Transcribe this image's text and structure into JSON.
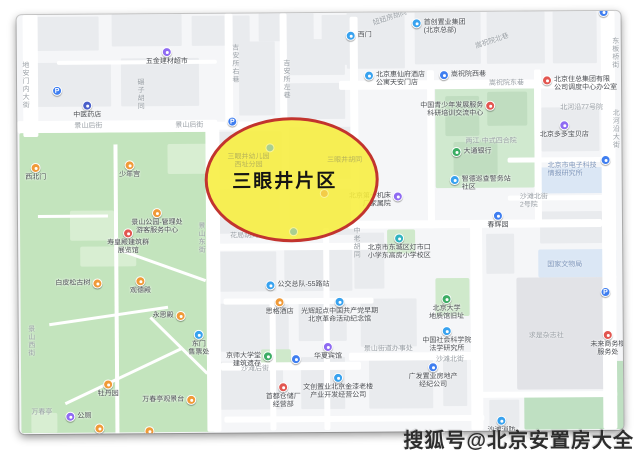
{
  "watermark": {
    "text": "搜狐号@北京安置房大全"
  },
  "highlight": {
    "label": "三眼井片区",
    "x": 187,
    "y": 104,
    "w": 174,
    "h": 125,
    "fill": "rgba(247,238,62,0.88)",
    "border": "#c2342e"
  },
  "icon_colors": {
    "blue": "#3f7ef0",
    "lightblue": "#38a2ef",
    "teal": "#2fb3c0",
    "purple": "#8f6bf2",
    "orange": "#f09a38",
    "red": "#e25650",
    "green": "#3cad64",
    "darkblue": "#4a5fc9"
  },
  "blocks": [
    {
      "x": 20,
      "y": 2,
      "w": 62,
      "h": 34
    },
    {
      "x": 95,
      "y": 0,
      "w": 70,
      "h": 32
    },
    {
      "x": 175,
      "y": 2,
      "w": 58,
      "h": 30
    },
    {
      "x": 242,
      "y": 0,
      "w": 55,
      "h": 28
    },
    {
      "x": 305,
      "y": 2,
      "w": 40,
      "h": 50
    },
    {
      "x": 16,
      "y": 48,
      "w": 78,
      "h": 44
    },
    {
      "x": 104,
      "y": 44,
      "w": 78,
      "h": 48
    },
    {
      "x": 222,
      "y": 28,
      "w": 36,
      "h": 74
    },
    {
      "x": 270,
      "y": 26,
      "w": 58,
      "h": 36
    },
    {
      "x": 270,
      "y": 70,
      "w": 58,
      "h": 36
    },
    {
      "x": 198,
      "y": 118,
      "w": 66,
      "h": 48
    },
    {
      "x": 272,
      "y": 114,
      "w": 66,
      "h": 52
    },
    {
      "x": 200,
      "y": 176,
      "w": 62,
      "h": 44
    },
    {
      "x": 272,
      "y": 176,
      "w": 66,
      "h": 46
    },
    {
      "x": 196,
      "y": 238,
      "w": 62,
      "h": 40
    },
    {
      "x": 266,
      "y": 234,
      "w": 68,
      "h": 44
    },
    {
      "x": 200,
      "y": 290,
      "w": 70,
      "h": 48
    },
    {
      "x": 280,
      "y": 288,
      "w": 48,
      "h": 40
    },
    {
      "x": 198,
      "y": 348,
      "w": 66,
      "h": 48
    },
    {
      "x": 282,
      "y": 344,
      "w": 44,
      "h": 52
    },
    {
      "x": 336,
      "y": 220,
      "w": 30,
      "h": 56
    },
    {
      "x": 342,
      "y": 286,
      "w": 56,
      "h": 48
    },
    {
      "x": 350,
      "y": 342,
      "w": 64,
      "h": 54
    },
    {
      "x": 424,
      "y": 344,
      "w": 24,
      "h": 50
    },
    {
      "x": 468,
      "y": 222,
      "w": 28,
      "h": 40
    },
    {
      "x": 330,
      "y": 0,
      "w": 58,
      "h": 56
    },
    {
      "x": 398,
      "y": 0,
      "w": 66,
      "h": 52
    },
    {
      "x": 470,
      "y": 0,
      "w": 58,
      "h": 52
    },
    {
      "x": 536,
      "y": 0,
      "w": 44,
      "h": 52
    },
    {
      "x": 524,
      "y": 96,
      "w": 58,
      "h": 44
    },
    {
      "x": 522,
      "y": 200,
      "w": 62,
      "h": 32
    },
    {
      "x": 470,
      "y": 388,
      "w": 30,
      "h": 28
    }
  ],
  "areas": [
    {
      "x": 2,
      "y": 118,
      "w": 194,
      "h": 300,
      "c": "#c3e4bd",
      "name": "jingshan-park"
    },
    {
      "x": 52,
      "y": 196,
      "w": 44,
      "h": 30,
      "c": "#d8eed2",
      "name": "park-structure"
    },
    {
      "x": 62,
      "y": 232,
      "w": 56,
      "h": 20,
      "c": "#d8eed2",
      "name": "park-structure"
    },
    {
      "x": 12,
      "y": 398,
      "w": 26,
      "h": 20,
      "c": "#d8eed2",
      "name": "park-structure"
    },
    {
      "x": 150,
      "y": 130,
      "w": 40,
      "h": 30,
      "c": "#d8eed2",
      "name": "park-structure"
    },
    {
      "x": 418,
      "y": 74,
      "w": 99,
      "h": 102,
      "c": "#d0e9cf",
      "name": "temple-compound"
    },
    {
      "x": 428,
      "y": 84,
      "w": 34,
      "h": 40,
      "c": "#c0ddc0",
      "name": "compound-building"
    },
    {
      "x": 470,
      "y": 80,
      "w": 40,
      "h": 34,
      "c": "#c0ddc0",
      "name": "compound-building"
    },
    {
      "x": 436,
      "y": 130,
      "w": 44,
      "h": 34,
      "c": "#c0ddc0",
      "name": "compound-building"
    },
    {
      "x": 369,
      "y": 217,
      "w": 28,
      "h": 24,
      "c": "#cfe9cb",
      "name": "school-green"
    },
    {
      "x": 417,
      "y": 266,
      "w": 34,
      "h": 38,
      "c": "#cfe9cb",
      "name": "geology-hall-green"
    },
    {
      "x": 242,
      "y": 336,
      "w": 30,
      "h": 16,
      "c": "#cfe9cb",
      "name": "daxuetang-green"
    },
    {
      "x": 505,
      "y": 384,
      "w": 117,
      "h": 34,
      "c": "#bfe0c2",
      "name": "green-strip"
    },
    {
      "x": 588,
      "y": 350,
      "w": 34,
      "h": 68,
      "c": "#bfe0c2",
      "name": "green-strip"
    },
    {
      "x": 518,
      "y": 156,
      "w": 70,
      "h": 26,
      "c": "#dbe7f5",
      "name": "blue-building"
    },
    {
      "x": 520,
      "y": 238,
      "w": 78,
      "h": 28,
      "c": "#dbe7f5",
      "name": "blue-building"
    },
    {
      "x": 498,
      "y": 266,
      "w": 100,
      "h": 112,
      "c": "#e2e3e7",
      "name": "large-building"
    }
  ],
  "roads": [
    {
      "x": 6,
      "y": 0,
      "w": 15,
      "h": 122
    },
    {
      "x": 0,
      "y": 106,
      "w": 200,
      "h": 12
    },
    {
      "x": 196,
      "y": 108,
      "w": 60,
      "h": 8
    },
    {
      "x": 188,
      "y": 112,
      "w": 14,
      "h": 306
    },
    {
      "x": 208,
      "y": 0,
      "w": 8,
      "h": 112
    },
    {
      "x": 263,
      "y": 0,
      "w": 7,
      "h": 110
    },
    {
      "x": 40,
      "y": 46,
      "w": 160,
      "h": 4
    },
    {
      "x": 322,
      "y": 68,
      "w": 276,
      "h": 9
    },
    {
      "x": 333,
      "y": 4,
      "w": 8,
      "h": 212
    },
    {
      "x": 410,
      "y": 58,
      "w": 7,
      "h": 158
    },
    {
      "x": 517,
      "y": 58,
      "w": 7,
      "h": 158
    },
    {
      "x": 584,
      "y": 0,
      "w": 14,
      "h": 418
    },
    {
      "x": 330,
      "y": 208,
      "w": 254,
      "h": 8
    },
    {
      "x": 190,
      "y": 230,
      "w": 170,
      "h": 7
    },
    {
      "x": 205,
      "y": 285,
      "w": 150,
      "h": 6
    },
    {
      "x": 202,
      "y": 349,
      "w": 140,
      "h": 8
    },
    {
      "x": 330,
      "y": 340,
      "w": 130,
      "h": 8
    },
    {
      "x": 452,
      "y": 212,
      "w": 12,
      "h": 206
    },
    {
      "x": 305,
      "y": 215,
      "w": 6,
      "h": 202
    },
    {
      "x": 251,
      "y": 285,
      "w": 6,
      "h": 132
    },
    {
      "x": 205,
      "y": 403,
      "w": 260,
      "h": 6
    },
    {
      "x": 490,
      "y": 146,
      "w": 96,
      "h": 5
    },
    {
      "x": 490,
      "y": 184,
      "w": 96,
      "h": 5
    },
    {
      "x": 460,
      "y": 380,
      "w": 138,
      "h": 6
    }
  ],
  "paths": [
    {
      "x": 96,
      "y": 130,
      "w": 4,
      "h": 290,
      "r": 0
    },
    {
      "x": 30,
      "y": 300,
      "w": 120,
      "h": 3,
      "r": -8
    },
    {
      "x": 40,
      "y": 360,
      "w": 130,
      "h": 3,
      "r": -25
    },
    {
      "x": 100,
      "y": 250,
      "w": 90,
      "h": 3,
      "r": 20
    },
    {
      "x": 20,
      "y": 200,
      "w": 70,
      "h": 3,
      "r": 0
    },
    {
      "x": 120,
      "y": 330,
      "w": 80,
      "h": 3,
      "r": 45
    }
  ],
  "pois": [
    {
      "x": 150,
      "y": 38,
      "c": "purple",
      "lines": [
        "五金建材超市"
      ],
      "pos": "below",
      "name": "hardware-store"
    },
    {
      "x": 40,
      "y": 76,
      "c": "blue",
      "glyph": "P",
      "name": "parking"
    },
    {
      "x": 70,
      "y": 91,
      "c": "darkblue",
      "lines": [
        "中医药店"
      ],
      "pos": "below",
      "name": "tcm-pharmacy"
    },
    {
      "x": 18,
      "y": 153,
      "c": "orange",
      "lines": [
        "西北门"
      ],
      "pos": "below",
      "name": "park-northwest-gate"
    },
    {
      "x": 112,
      "y": 151,
      "c": "orange",
      "lines": [
        "少年宫"
      ],
      "pos": "below",
      "name": "youth-palace"
    },
    {
      "x": 139,
      "y": 199,
      "c": "orange",
      "lines": [
        "景山公园-管理处",
        "游客服务中心"
      ],
      "pos": "below",
      "name": "park-admin"
    },
    {
      "x": 110,
      "y": 219,
      "c": "red",
      "lines": [
        "寿皇殿建筑群",
        "展览馆"
      ],
      "pos": "below",
      "name": "shouhuang-hall"
    },
    {
      "x": 79,
      "y": 269,
      "c": "orange",
      "lines": [
        "白皮松古树"
      ],
      "pos": "left",
      "name": "ancient-pine"
    },
    {
      "x": 122,
      "y": 267,
      "c": "orange",
      "lines": [
        "观德殿"
      ],
      "pos": "below",
      "name": "guande-hall"
    },
    {
      "x": 162,
      "y": 302,
      "c": "orange",
      "lines": [
        "永思殿"
      ],
      "pos": "left",
      "name": "yongsi-hall"
    },
    {
      "x": 180,
      "y": 321,
      "c": "lightblue",
      "lines": [
        "东门",
        "售票处"
      ],
      "pos": "below",
      "name": "park-east-gate"
    },
    {
      "x": 89,
      "y": 370,
      "c": "orange",
      "lines": [
        "牡丹园"
      ],
      "pos": "below",
      "name": "peony-garden"
    },
    {
      "x": 172,
      "y": 386,
      "c": "orange",
      "lines": [
        "万春亭观景台"
      ],
      "pos": "left",
      "name": "viewing-platform"
    },
    {
      "x": 51,
      "y": 402,
      "c": "purple",
      "lines": [
        "公厕"
      ],
      "pos": "right",
      "name": "restroom"
    },
    {
      "x": 80,
      "y": 414,
      "c": "orange",
      "name": "park-poi"
    },
    {
      "x": 130,
      "y": 417,
      "c": "orange",
      "name": "park-poi"
    },
    {
      "x": 215,
      "y": 108,
      "c": "blue",
      "glyph": "P",
      "name": "parking"
    },
    {
      "x": 252,
      "y": 272,
      "c": "lightblue",
      "lines": [
        "公交总队-55路站"
      ],
      "pos": "right",
      "name": "bus-stop"
    },
    {
      "x": 261,
      "y": 289,
      "c": "orange",
      "lines": [
        "思格酒店"
      ],
      "pos": "below",
      "name": "hotel"
    },
    {
      "x": 321,
      "y": 289,
      "c": "lightblue",
      "lines": [
        "光辉起点中国共产党早期",
        "北京革命活动纪念馆"
      ],
      "pos": "below",
      "name": "memorial-hall"
    },
    {
      "x": 309,
      "y": 334,
      "c": "purple",
      "lines": [
        "华夏宾馆"
      ],
      "pos": "below",
      "name": "huaxia-hotel"
    },
    {
      "x": 249,
      "y": 343,
      "c": "green",
      "lines": [
        "京师大学堂",
        "建筑遗存"
      ],
      "pos": "left",
      "name": "imperial-university-site"
    },
    {
      "x": 277,
      "y": 346,
      "c": "blue",
      "name": "poi"
    },
    {
      "x": 319,
      "y": 365,
      "c": "lightblue",
      "lines": [
        "文创置业北京金漆老楼",
        "产业开发经营公司"
      ],
      "pos": "below",
      "name": "cultural-industry-co"
    },
    {
      "x": 264,
      "y": 374,
      "c": "red",
      "lines": [
        "首都仓储厂",
        "经营部"
      ],
      "pos": "below",
      "name": "warehouse"
    },
    {
      "x": 428,
      "y": 287,
      "c": "green",
      "lines": [
        "北京大学",
        "地质馆旧址"
      ],
      "pos": "below",
      "name": "pku-geology-hall"
    },
    {
      "x": 428,
      "y": 319,
      "c": "lightblue",
      "lines": [
        "中国社会科学院",
        "法学研究所"
      ],
      "pos": "below",
      "name": "cass-law-institute"
    },
    {
      "x": 414,
      "y": 355,
      "c": "blue",
      "lines": [
        "广发置业房地产",
        "经纪公司"
      ],
      "pos": "below",
      "name": "realty-agency"
    },
    {
      "x": 589,
      "y": 324,
      "c": "red",
      "lines": [
        "未来商务楼",
        "服务处"
      ],
      "pos": "below",
      "name": "office-building"
    },
    {
      "x": 587,
      "y": 281,
      "c": "blue",
      "glyph": "P",
      "name": "parking"
    },
    {
      "x": 547,
      "y": 114,
      "c": "purple",
      "lines": [
        "北京多多宝贝店"
      ],
      "pos": "below",
      "name": "baby-store"
    },
    {
      "x": 530,
      "y": 69,
      "c": "red",
      "lines": [
        "北京住总集团有限",
        "公司调度中心办公室"
      ],
      "pos": "right",
      "name": "construction-group-office"
    },
    {
      "x": 400,
      "y": 11,
      "c": "lightblue",
      "lines": [
        "首创置业集团",
        "(北京总部)"
      ],
      "pos": "right",
      "name": "capital-development-group"
    },
    {
      "x": 334,
      "y": 23,
      "c": "lightblue",
      "lines": [
        "西门"
      ],
      "pos": "right",
      "name": "west-gate"
    },
    {
      "x": 427,
      "y": 63,
      "c": "blue",
      "lines": [
        "嵩祝院西巷"
      ],
      "pos": "right",
      "name": "songzhuyuan-west-lane"
    },
    {
      "x": 352,
      "y": 63,
      "c": "lightblue",
      "lines": [
        "北京惠仙府酒店",
        "公寓天安门店"
      ],
      "pos": "right",
      "name": "hotel-apartment"
    },
    {
      "x": 473,
      "y": 94,
      "c": "red",
      "lines": [
        "中国青少年发展服务",
        "科研培训交流中心"
      ],
      "pos": "left",
      "name": "youth-center"
    },
    {
      "x": 439,
      "y": 140,
      "c": "green",
      "lines": [
        "大通银行"
      ],
      "pos": "right",
      "name": "bank"
    },
    {
      "x": 437,
      "y": 168,
      "c": "lightblue",
      "lines": [
        "智德巡查警务站",
        "社区"
      ],
      "pos": "right",
      "name": "police-post"
    },
    {
      "x": 480,
      "y": 204,
      "c": "blue",
      "lines": [
        "春辉园"
      ],
      "pos": "below",
      "name": "chunhui-garden"
    },
    {
      "x": 381,
      "y": 226,
      "c": "teal",
      "lines": [
        "北京市东城区灯市口",
        "小学东高房小学校区"
      ],
      "pos": "below",
      "name": "primary-school"
    },
    {
      "x": 482,
      "y": 409,
      "c": "lightblue",
      "lines": [
        "沙滩消防",
        "救援站"
      ],
      "pos": "below",
      "name": "fire-station"
    },
    {
      "x": 380,
      "y": 184,
      "c": "purple",
      "lines": [
        "北京第一机床",
        "厂家属院"
      ],
      "pos": "left",
      "name": "residential-compound"
    },
    {
      "x": 588,
      "y": 149,
      "c": "blue",
      "name": "poi"
    },
    {
      "x": 587,
      "y": 1,
      "c": "blue",
      "name": "poi"
    }
  ],
  "streets": [
    {
      "lines": [
        "地安门内大街"
      ],
      "x": 4,
      "y": 46,
      "v": true,
      "name": "dianmennei-st"
    },
    {
      "lines": [
        "碾子胡同"
      ],
      "x": 119,
      "y": 64,
      "v": true,
      "name": "nianzi-hutong"
    },
    {
      "lines": [
        "吉安所右巷"
      ],
      "x": 214,
      "y": 30,
      "v": true,
      "name": "jiansuo-right-lane"
    },
    {
      "lines": [
        "吉安所左巷"
      ],
      "x": 265,
      "y": 46,
      "v": true,
      "name": "jiansuo-left-lane"
    },
    {
      "lines": [
        "景山后街"
      ],
      "x": 57,
      "y": 108,
      "name": "jingshan-back-st"
    },
    {
      "lines": [
        "景山后街"
      ],
      "x": 158,
      "y": 108,
      "name": "jingshan-back-st"
    },
    {
      "lines": [
        "景山东街"
      ],
      "x": 179,
      "y": 208,
      "v": true,
      "name": "jingshan-east-st"
    },
    {
      "lines": [
        "景山西街"
      ],
      "x": 8,
      "y": 310,
      "v": true,
      "name": "jingshan-west-st"
    },
    {
      "lines": [
        "妞妞房胡同"
      ],
      "x": 356,
      "y": 2,
      "r": -18,
      "name": "niuniufang-hutong"
    },
    {
      "lines": [
        "嵩祝院北巷"
      ],
      "x": 458,
      "y": 26,
      "r": -18,
      "name": "songzhuyuan-north-lane"
    },
    {
      "lines": [
        "嵩祝院东巷"
      ],
      "x": 472,
      "y": 68,
      "name": "songzhuyuan-east-lane"
    },
    {
      "lines": [
        "北河沿大街"
      ],
      "x": 594,
      "y": 98,
      "v": true,
      "name": "beiheyan-st"
    },
    {
      "lines": [
        "东板桥街"
      ],
      "x": 594,
      "y": 26,
      "v": true,
      "name": "dongbanqiao-st"
    },
    {
      "lines": [
        "花局胡同"
      ],
      "x": 212,
      "y": 219,
      "name": "huaju-hutong"
    },
    {
      "lines": [
        "中老胡同"
      ],
      "x": 334,
      "y": 214,
      "v": true,
      "name": "zhonglao-hutong"
    },
    {
      "lines": [
        "沙滩后街"
      ],
      "x": 222,
      "y": 352,
      "name": "shatan-back-st"
    },
    {
      "lines": [
        "沙滩北街"
      ],
      "x": 417,
      "y": 344,
      "name": "shatan-north-st"
    },
    {
      "lines": [
        "景山街道办事处"
      ],
      "x": 345,
      "y": 333,
      "name": "subdistrict-office"
    },
    {
      "lines": [
        "求是杂志社"
      ],
      "x": 510,
      "y": 321,
      "name": "qiushi-magazine"
    },
    {
      "lines": [
        "国家文物局"
      ],
      "x": 529,
      "y": 250,
      "blue": true,
      "name": "cultural-heritage-admin"
    },
    {
      "lines": [
        "北京市电子科技",
        "情报研究所"
      ],
      "x": 530,
      "y": 151,
      "blue": true,
      "name": "electronics-institute"
    },
    {
      "lines": [
        "北河沿77号院"
      ],
      "x": 543,
      "y": 93,
      "name": "beiheyan-77-compound"
    },
    {
      "lines": [
        "沙滩北街",
        "2号院"
      ],
      "x": 502,
      "y": 182,
      "name": "shatan-2-compound"
    },
    {
      "lines": [
        "两江·中式四合院"
      ],
      "x": 448,
      "y": 126,
      "name": "courtyard-residence"
    },
    {
      "lines": [
        "万春亭"
      ],
      "x": 12,
      "y": 394,
      "name": "wanchun-pavilion"
    }
  ],
  "ghosts": [
    {
      "x": 231,
      "y": 130,
      "c": "lightblue",
      "lines": [
        "三眼井幼儿园",
        "西址分园"
      ],
      "name": "sanyanjing-kindergarten"
    },
    {
      "x": 327,
      "y": 144,
      "lines": [
        "三眼井胡同"
      ],
      "name": "sanyanjing-hutong"
    },
    {
      "x": 302,
      "y": 176,
      "c": "orange",
      "lines": [],
      "name": "ghost-poi"
    },
    {
      "x": 271,
      "y": 214,
      "c": "lightblue",
      "lines": [],
      "name": "ghost-poi"
    }
  ]
}
